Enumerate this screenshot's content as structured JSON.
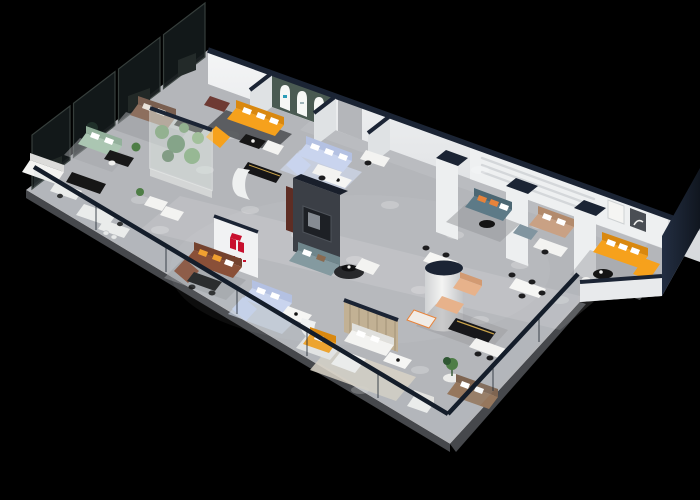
{
  "colors": {
    "background": "#000000",
    "floor": "#b4b6ba",
    "floor_edge": "#46484c",
    "wall_white": "#eef0f1",
    "wall_shade": "#dfe2e4",
    "navy_cap": "#1b2434",
    "navy_wall": "#1a2230",
    "charcoal_wall": "#3b3f46",
    "maroon_accent": "#5e2d24",
    "smoked_glass": "#141a1b",
    "smoked_glass_frame": "#39423f",
    "facade_glass": "#aebfc4",
    "facade_rail": "#141d2a",
    "arch_wall_green": "#4a5a52",
    "arch_white": "#f6f7f5",
    "logo_red": "#c8102e",
    "brand_blue": "#2d9db8",
    "sofa_orange": "#f6a11c",
    "sofa_orange_dark": "#d9880f",
    "sofa_blue_light": "#c9d4ee",
    "sofa_blue_dark": "#b4c1e2",
    "sofa_teal": "#5d7a87",
    "sofa_teal_dark": "#4c6773",
    "sofa_teal_muted": "#849aa0",
    "sofa_green_sage": "#abc6b2",
    "sofa_brown": "#8d6f5e",
    "sofa_leather_red": "#8a5038",
    "sofa_leather_brown": "#96775d",
    "sofa_tan": "#c9a184",
    "armchair_peach": "#e7b28b",
    "sofa_white": "#f3f3f1",
    "pillow_orange": "#e8833a",
    "table_black": "#161616",
    "gold_trim": "#c9a24a",
    "rug_blue": "#ccd5e6",
    "rug_beige": "#d8d2c6",
    "rug_gray": "#9a9ca0",
    "rug_dark": "#4b4d51",
    "wood_partition": "#c2b194",
    "wood_stripe": "#a8977c",
    "plant_green": "#4e7d46",
    "plant_dark": "#2f5733",
    "plant_light": "#6a9a5a",
    "terrarium_glass": "#e7f0ea",
    "art_dark": "#4a4e54",
    "tv_black": "#1d2025"
  }
}
